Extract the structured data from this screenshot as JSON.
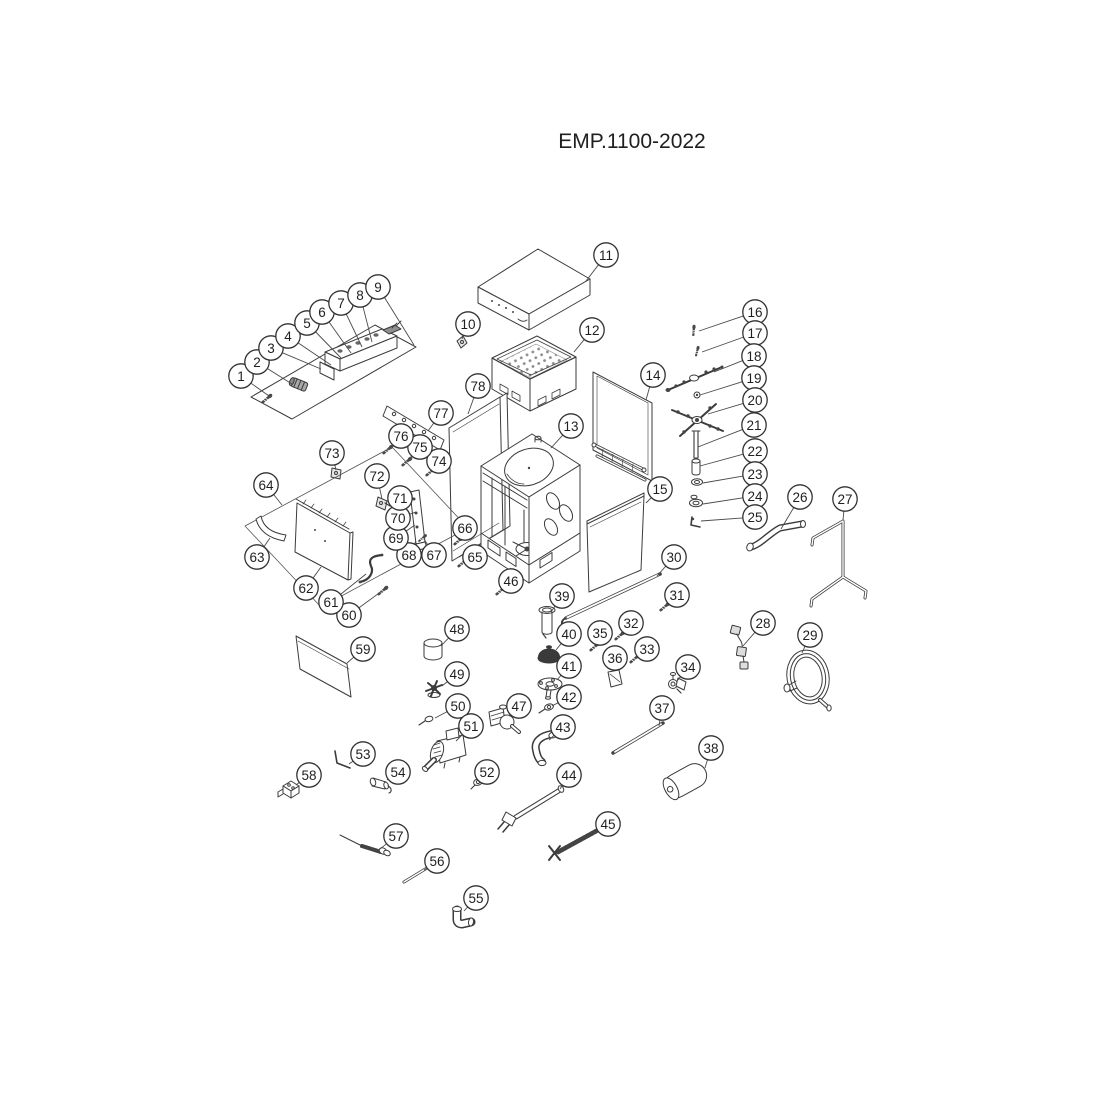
{
  "title": "EMP.1100-2022",
  "colors": {
    "background": "#ffffff",
    "line_art": "#3b3b3b",
    "callout_stroke": "#333333",
    "callout_text": "#1f1f1f"
  },
  "diagram": {
    "callouts": [
      {
        "n": "1",
        "x": 241,
        "y": 376,
        "tx": 269,
        "ty": 396
      },
      {
        "n": "2",
        "x": 257,
        "y": 362,
        "tx": 292,
        "ty": 384
      },
      {
        "n": "3",
        "x": 271,
        "y": 348,
        "tx": 321,
        "ty": 369
      },
      {
        "n": "4",
        "x": 288,
        "y": 336,
        "tx": 331,
        "ty": 365
      },
      {
        "n": "5",
        "x": 307,
        "y": 323,
        "tx": 341,
        "ty": 358
      },
      {
        "n": "6",
        "x": 322,
        "y": 312,
        "tx": 351,
        "ty": 353
      },
      {
        "n": "7",
        "x": 341,
        "y": 303,
        "tx": 362,
        "ty": 347
      },
      {
        "n": "8",
        "x": 360,
        "y": 295,
        "tx": 372,
        "ty": 342
      },
      {
        "n": "9",
        "x": 378,
        "y": 287,
        "tx": 414,
        "ty": 345
      },
      {
        "n": "10",
        "x": 468,
        "y": 324,
        "tx": 462,
        "ty": 339
      },
      {
        "n": "11",
        "x": 606,
        "y": 255,
        "tx": 586,
        "ty": 281
      },
      {
        "n": "12",
        "x": 592,
        "y": 330,
        "tx": 574,
        "ty": 352
      },
      {
        "n": "13",
        "x": 571,
        "y": 426,
        "tx": 551,
        "ty": 448
      },
      {
        "n": "14",
        "x": 653,
        "y": 375,
        "tx": 646,
        "ty": 400
      },
      {
        "n": "15",
        "x": 660,
        "y": 489,
        "tx": 646,
        "ty": 503
      },
      {
        "n": "16",
        "x": 755,
        "y": 312,
        "tx": 699,
        "ty": 331
      },
      {
        "n": "17",
        "x": 755,
        "y": 333,
        "tx": 702,
        "ty": 352
      },
      {
        "n": "18",
        "x": 754,
        "y": 356,
        "tx": 714,
        "ty": 372
      },
      {
        "n": "19",
        "x": 754,
        "y": 378,
        "tx": 700,
        "ty": 395
      },
      {
        "n": "20",
        "x": 755,
        "y": 400,
        "tx": 708,
        "ty": 414
      },
      {
        "n": "21",
        "x": 754,
        "y": 425,
        "tx": 698,
        "ty": 447
      },
      {
        "n": "22",
        "x": 755,
        "y": 451,
        "tx": 700,
        "ty": 466
      },
      {
        "n": "23",
        "x": 755,
        "y": 474,
        "tx": 703,
        "ty": 483
      },
      {
        "n": "24",
        "x": 755,
        "y": 496,
        "tx": 703,
        "ty": 504
      },
      {
        "n": "25",
        "x": 755,
        "y": 517,
        "tx": 701,
        "ty": 521
      },
      {
        "n": "26",
        "x": 800,
        "y": 497,
        "tx": 781,
        "ty": 529
      },
      {
        "n": "27",
        "x": 845,
        "y": 499,
        "tx": 843,
        "ty": 520
      },
      {
        "n": "28",
        "x": 763,
        "y": 623,
        "tx": 743,
        "ty": 646
      },
      {
        "n": "29",
        "x": 810,
        "y": 635,
        "tx": 802,
        "ty": 653
      },
      {
        "n": "30",
        "x": 674,
        "y": 557,
        "tx": 657,
        "ty": 576
      },
      {
        "n": "31",
        "x": 677,
        "y": 595,
        "tx": 667,
        "ty": 606
      },
      {
        "n": "32",
        "x": 631,
        "y": 623,
        "tx": 621,
        "ty": 635
      },
      {
        "n": "33",
        "x": 647,
        "y": 649,
        "tx": 636,
        "ty": 658
      },
      {
        "n": "34",
        "x": 688,
        "y": 667,
        "tx": 678,
        "ty": 680
      },
      {
        "n": "35",
        "x": 600,
        "y": 633,
        "tx": 596,
        "ty": 645
      },
      {
        "n": "36",
        "x": 615,
        "y": 658,
        "tx": 613,
        "ty": 671
      },
      {
        "n": "37",
        "x": 662,
        "y": 708,
        "tx": 659,
        "ty": 726
      },
      {
        "n": "38",
        "x": 711,
        "y": 748,
        "tx": 705,
        "ty": 768
      },
      {
        "n": "39",
        "x": 562,
        "y": 596,
        "tx": 551,
        "ty": 612
      },
      {
        "n": "40",
        "x": 569,
        "y": 634,
        "tx": 556,
        "ty": 650
      },
      {
        "n": "41",
        "x": 569,
        "y": 666,
        "tx": 557,
        "ty": 680
      },
      {
        "n": "42",
        "x": 569,
        "y": 697,
        "tx": 552,
        "ty": 706
      },
      {
        "n": "43",
        "x": 563,
        "y": 727,
        "tx": 549,
        "ty": 740
      },
      {
        "n": "44",
        "x": 569,
        "y": 775,
        "tx": 560,
        "ty": 789
      },
      {
        "n": "45",
        "x": 608,
        "y": 824,
        "tx": 598,
        "ty": 831
      },
      {
        "n": "46",
        "x": 511,
        "y": 581,
        "tx": 503,
        "ty": 590
      },
      {
        "n": "47",
        "x": 519,
        "y": 706,
        "tx": 509,
        "ty": 716
      },
      {
        "n": "48",
        "x": 457,
        "y": 629,
        "tx": 441,
        "ty": 646
      },
      {
        "n": "49",
        "x": 457,
        "y": 674,
        "tx": 442,
        "ty": 686
      },
      {
        "n": "50",
        "x": 458,
        "y": 706,
        "tx": 435,
        "ty": 718
      },
      {
        "n": "51",
        "x": 471,
        "y": 726,
        "tx": 456,
        "ty": 741
      },
      {
        "n": "52",
        "x": 487,
        "y": 772,
        "tx": 480,
        "ty": 781
      },
      {
        "n": "53",
        "x": 363,
        "y": 754,
        "tx": 349,
        "ty": 764
      },
      {
        "n": "54",
        "x": 398,
        "y": 772,
        "tx": 387,
        "ty": 780
      },
      {
        "n": "55",
        "x": 476,
        "y": 898,
        "tx": 464,
        "ty": 911
      },
      {
        "n": "56",
        "x": 437,
        "y": 861,
        "tx": 424,
        "ty": 870
      },
      {
        "n": "57",
        "x": 396,
        "y": 836,
        "tx": 380,
        "ty": 849
      },
      {
        "n": "58",
        "x": 309,
        "y": 775,
        "tx": 296,
        "ty": 785
      },
      {
        "n": "59",
        "x": 363,
        "y": 649,
        "tx": 347,
        "ty": 663
      },
      {
        "n": "60",
        "x": 349,
        "y": 615,
        "tx": 382,
        "ty": 591
      },
      {
        "n": "61",
        "x": 331,
        "y": 602,
        "tx": 366,
        "ty": 574
      },
      {
        "n": "62",
        "x": 306,
        "y": 588,
        "tx": 321,
        "ty": 567
      },
      {
        "n": "63",
        "x": 257,
        "y": 557,
        "tx": 270,
        "ty": 538
      },
      {
        "n": "64",
        "x": 266,
        "y": 485,
        "tx": 282,
        "ty": 505
      },
      {
        "n": "65",
        "x": 475,
        "y": 557,
        "tx": 464,
        "ty": 564
      },
      {
        "n": "66",
        "x": 465,
        "y": 528,
        "tx": 461,
        "ty": 541
      },
      {
        "n": "67",
        "x": 434,
        "y": 555,
        "tx": 424,
        "ty": 539
      },
      {
        "n": "68",
        "x": 409,
        "y": 555,
        "tx": 416,
        "ty": 541
      },
      {
        "n": "69",
        "x": 396,
        "y": 538,
        "tx": 415,
        "ty": 525
      },
      {
        "n": "70",
        "x": 398,
        "y": 518,
        "tx": 416,
        "ty": 512
      },
      {
        "n": "71",
        "x": 400,
        "y": 498,
        "tx": 414,
        "ty": 498
      },
      {
        "n": "72",
        "x": 377,
        "y": 476,
        "tx": 382,
        "ty": 499
      },
      {
        "n": "73",
        "x": 332,
        "y": 453,
        "tx": 336,
        "ty": 470
      },
      {
        "n": "74",
        "x": 439,
        "y": 461,
        "tx": 431,
        "ty": 472
      },
      {
        "n": "75",
        "x": 420,
        "y": 447,
        "tx": 409,
        "ty": 459
      },
      {
        "n": "76",
        "x": 401,
        "y": 436,
        "tx": 390,
        "ty": 448
      },
      {
        "n": "77",
        "x": 441,
        "y": 413,
        "tx": 428,
        "ty": 431
      },
      {
        "n": "78",
        "x": 478,
        "y": 386,
        "tx": 468,
        "ty": 414
      }
    ]
  }
}
